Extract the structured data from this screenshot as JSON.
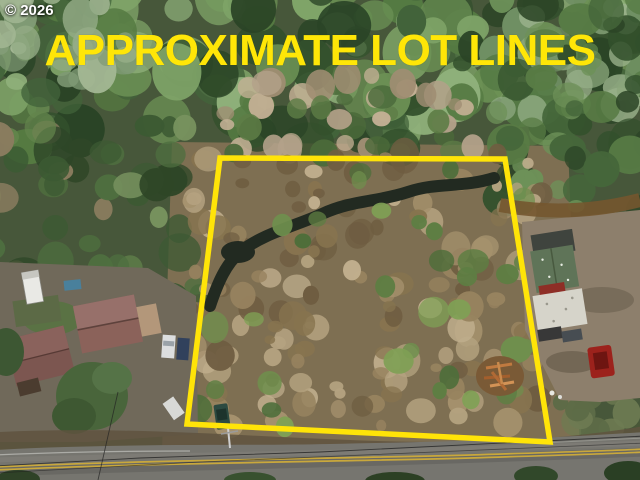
{
  "watermark": {
    "text": "© 2026",
    "color": "#ffffff"
  },
  "banner": {
    "text": "APPROXIMATE LOT LINES",
    "color": "#ffe607"
  },
  "lot_boundary": {
    "color": "#ffe408",
    "stroke_width": 5.5,
    "points": "220,158 505,159 550,442 187,424"
  },
  "scene": {
    "type": "aerial-drone-photo",
    "forest_base": "#47573a",
    "lot_brush": "#7e6f52",
    "creek": "#222a21",
    "road_surface": "#76756f",
    "road_centerline": "#c9a83c",
    "road_centerline_style": "double-yellow"
  }
}
